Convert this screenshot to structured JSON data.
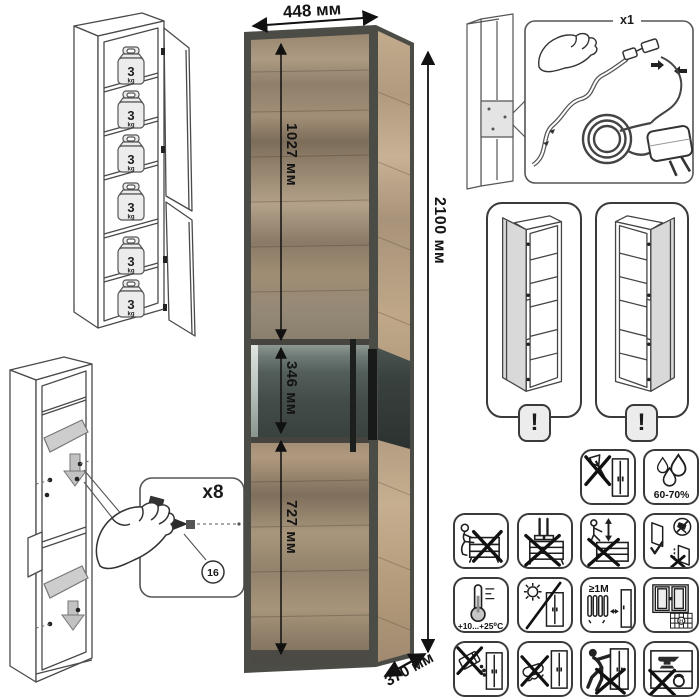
{
  "product_render": {
    "dimensions": {
      "width": "448 мм",
      "height": "2100 мм",
      "upper_door_height": "1027 мм",
      "glass_section_height": "346 мм",
      "lower_door_height": "727 мм",
      "depth": "370 мм"
    },
    "colors": {
      "wood_mid": "#9a8770",
      "wood_light": "#bfa788",
      "frame_dark": "#4c4c46",
      "glass_dark": "#3c4441",
      "handle_black": "#1c1f1e"
    }
  },
  "max_load_diagram": {
    "shelf_load_value": "3",
    "shelf_load_unit": "kg",
    "shelves_count": 6
  },
  "assembly_diagram": {
    "fastener_quantity": "x8",
    "fastener_part_number": "16"
  },
  "led_kit_diagram": {
    "kit_quantity": "x1"
  },
  "door_reversal_diagram": {
    "warning_mark": "!",
    "variants": [
      "door-hinged-left",
      "door-hinged-right"
    ]
  },
  "care_icons": {
    "humidity_range": "60-70%",
    "temperature_range": "+10...+25⁰C",
    "heater_min_distance": "≥1M",
    "ventilation_calendar_day": "21",
    "items": [
      "no-sharp-tools-icon",
      "humidity-icon",
      "no-sitting-icon",
      "no-standing-icon",
      "no-climbing-icon",
      "door-mounting-icon",
      "temperature-range-icon",
      "no-direct-sunlight-icon",
      "heater-distance-icon",
      "ventilation-icon",
      "no-abrasive-cleaners-icon",
      "no-wet-cleaning-icon",
      "no-dragging-icon",
      "no-heavy-items-icon"
    ]
  }
}
